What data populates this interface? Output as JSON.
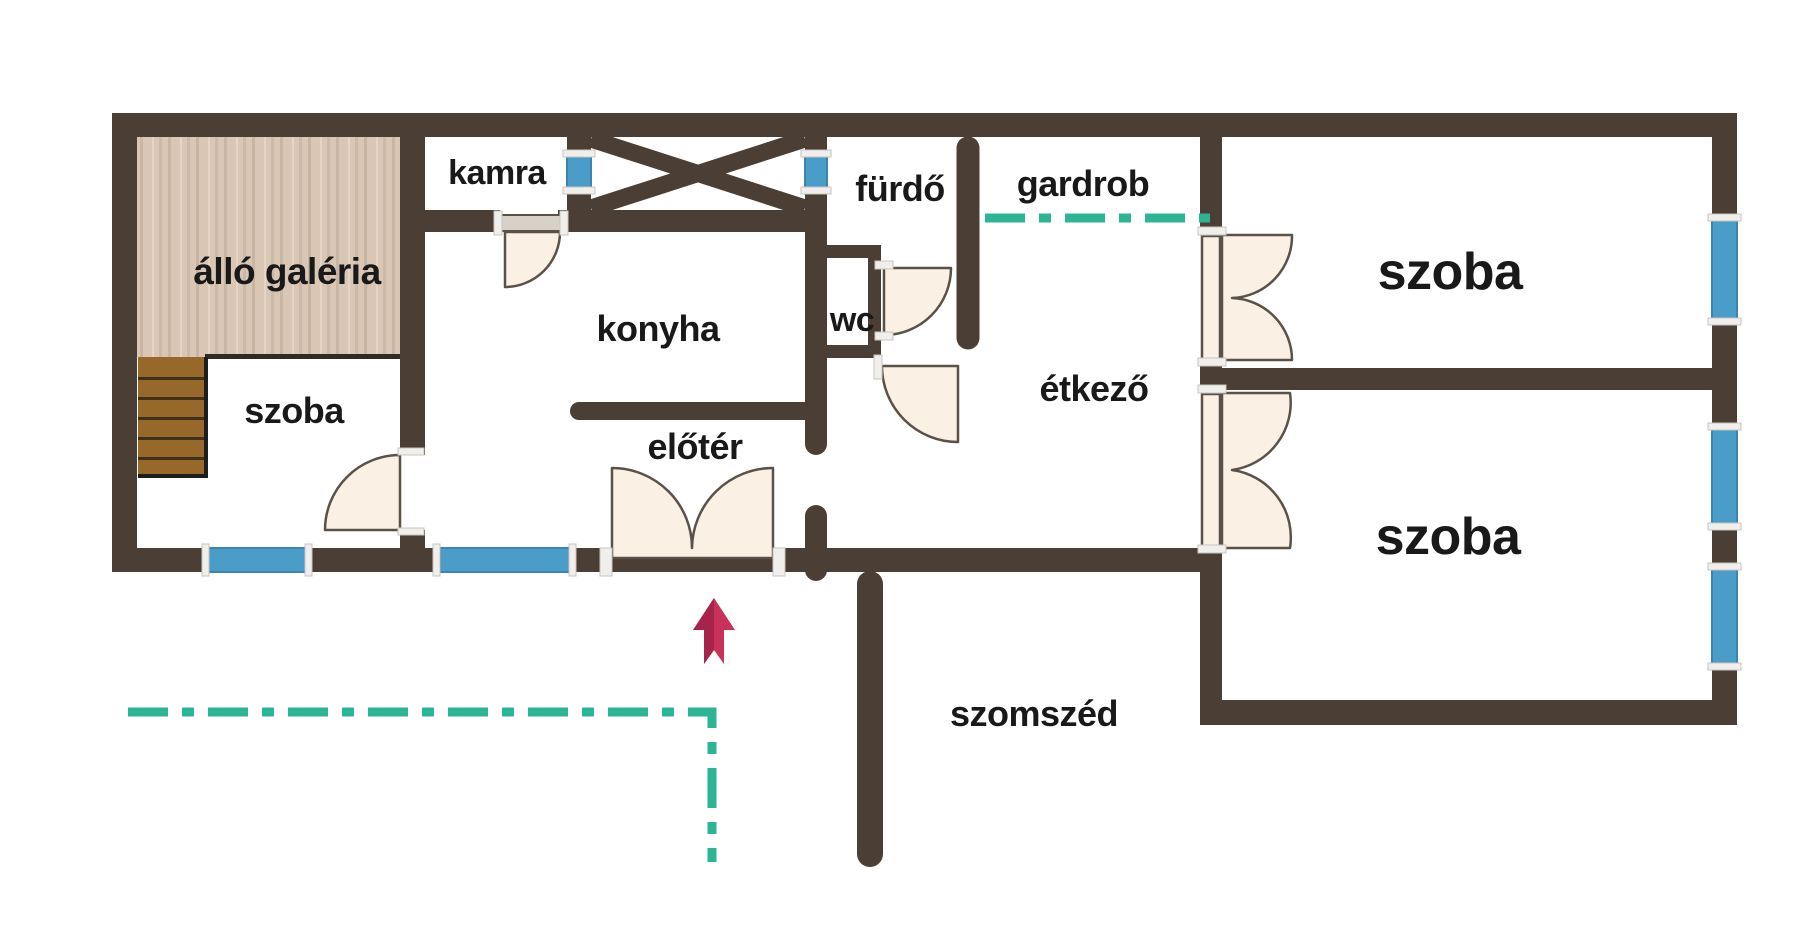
{
  "rooms": {
    "gallery": "álló galéria",
    "room_left": "szoba",
    "pantry": "kamra",
    "kitchen": "konyha",
    "bathroom": "fürdő",
    "toilet": "wc",
    "wardrobe": "gardrob",
    "dining": "étkező",
    "hall": "előtér",
    "room_top_right": "szoba",
    "room_bottom_right": "szoba"
  },
  "outside": {
    "neighbor": "szomszéd"
  },
  "icons": {
    "entrance_arrow": "up-arrow-entrance-icon",
    "shaft_cross": "x-cross-void-icon",
    "property_dash_line": "dash-dot-boundary-line"
  },
  "colors": {
    "background": "#ffffff",
    "wall": "#4a3e35",
    "window": "#4a9cc9",
    "window_edge": "#3c85ad",
    "window_frame": "#f1efec",
    "door": "#faf0e4",
    "door_stroke": "#5a5249",
    "property_line": "#2bb594",
    "entrance_arrow": "#c9305a",
    "entrance_arrow_dark": "#a62349",
    "wood_floor": "#d9c6b5",
    "stairs": "#96682a",
    "text": "#191919"
  }
}
